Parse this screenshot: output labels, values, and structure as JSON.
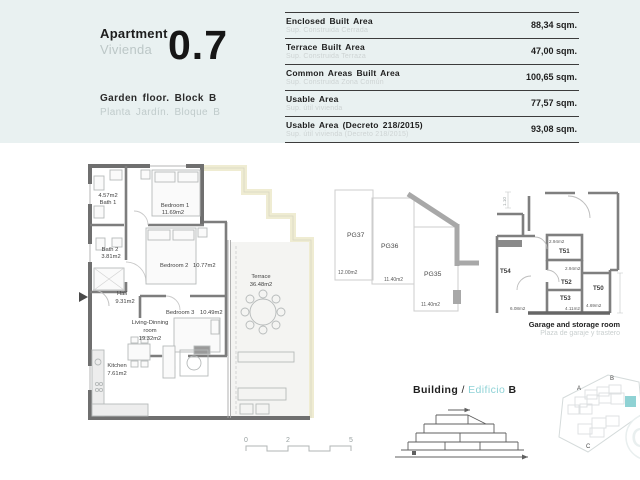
{
  "header": {
    "title_en": "Apartment",
    "title_es": "Vivienda",
    "unit": "0.7",
    "floor_en": "Garden floor.  Block B",
    "floor_es": "Planta Jardín.  Bloque B"
  },
  "areas": {
    "rows": [
      {
        "en": "Enclosed Built Area",
        "es": "Sup. Construida Cerrada",
        "value": "88,34 sqm."
      },
      {
        "en": "Terrace Built Area",
        "es": "Sup. Construida Terraza",
        "value": "47,00 sqm."
      },
      {
        "en": "Common Areas Built Area",
        "es": "Sup. Construida Zona Común",
        "value": "100,65 sqm."
      },
      {
        "en": "Usable Area",
        "es": "Sup. útil vivienda",
        "value": "77,57 sqm."
      },
      {
        "en": "Usable Area (Decreto 218/2015)",
        "es": "Sup. útil vivienda (Decreto 218/2015)",
        "value": "93,08 sqm."
      }
    ]
  },
  "floor_plan": {
    "bath1_area": "4.57m2",
    "bath1_name": "Bath 1",
    "bedroom1_name": "Bedroom 1",
    "bedroom1_area": "11.69m2",
    "bath2_name": "Bath 2",
    "bath2_area": "3.81m2",
    "bedroom2_name": "Bedroom 2",
    "bedroom2_area": "10.77m2",
    "hall_name": "Hall",
    "hall_area": "9.31m2",
    "bedroom3_name": "Bedroom 3",
    "bedroom3_area": "10.49m2",
    "living_line1": "Living-Dinning",
    "living_line2": "room",
    "living_area": "19.32m2",
    "kitchen_name": "Kitchen",
    "kitchen_area": "7.61m2",
    "terrace_name": "Terrace",
    "terrace_area": "36.48m2"
  },
  "parking": {
    "pg37_label": "PG37",
    "pg37_area": "12.00m2",
    "pg36_label": "PG36",
    "pg36_area": "11.40m2",
    "pg35_label": "PG35",
    "pg35_area": "11.40m2"
  },
  "storage": {
    "t54_label": "T54",
    "t54_area": "6.08m2",
    "t51_label": "T51",
    "t51_area": "2.94m2",
    "t52_label": "T52",
    "t52_area": "2.94m2",
    "t53_label": "T53",
    "t53_area": "4.11m2",
    "t50_label": "T50",
    "t50_area": "4.69m2",
    "dim_label": "1.10",
    "caption_en": "Garage and storage room",
    "caption_es": "Plaza de garaje y trastero"
  },
  "building": {
    "en": "Building",
    "sep": " / ",
    "es": "Edificio",
    "block": " B"
  },
  "site": {
    "a": "A",
    "b": "B",
    "c": "C"
  },
  "scale": {
    "t0": "0",
    "t2": "2",
    "t5": "5"
  },
  "colors": {
    "header_band": "#e9f1f1",
    "accent_teal": "#8ed2d6",
    "site_highlight": "#8fd2d4",
    "facade_yellow": "#efecd2"
  }
}
